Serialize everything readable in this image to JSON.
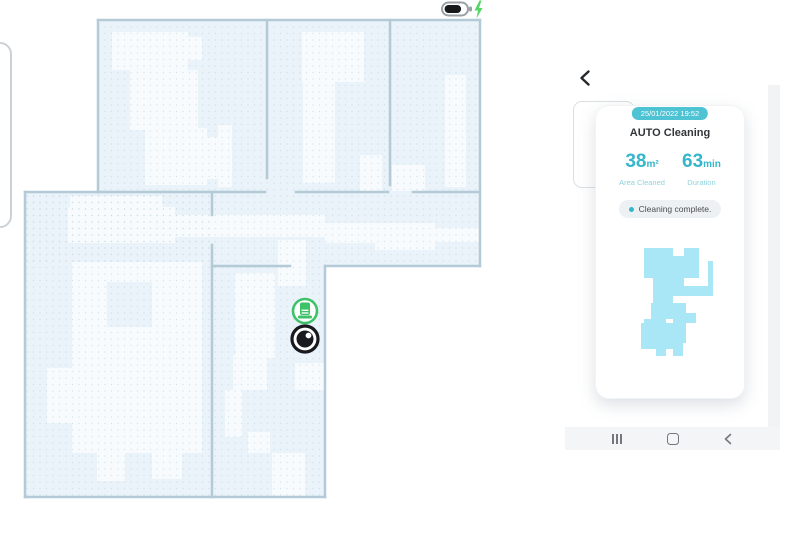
{
  "status_bar": {
    "battery_icon": "battery-charging-icon",
    "charging": true,
    "battery_level": "high"
  },
  "map_view": {
    "markers": [
      {
        "name": "charging-dock-marker",
        "color": "#3dc268"
      },
      {
        "name": "robot-marker",
        "color": "#1a1a1e"
      }
    ],
    "fill_color": "#e9f3f9",
    "wall_color": "#b4cad7",
    "patch_color": "#f7fbfd"
  },
  "phone": {
    "back_icon": "back-chevron-icon",
    "report_card": {
      "date_badge": "25/01/2022 19:52",
      "title": "AUTO Cleaning",
      "stats": [
        {
          "value": "38",
          "unit": "m²",
          "label": "Area Cleaned"
        },
        {
          "value": "63",
          "unit": "min",
          "label": "Duration"
        }
      ],
      "status": "Cleaning complete.",
      "thumbnail_color": "#a9e6f6"
    },
    "nav_bar": {
      "icons": [
        "recents-icon",
        "home-icon",
        "back-icon"
      ]
    }
  },
  "colors": {
    "accent_teal": "#35b6ca",
    "badge_teal": "#4dc3d3",
    "dock_green": "#3dc268",
    "bolt_green": "#57d569"
  }
}
